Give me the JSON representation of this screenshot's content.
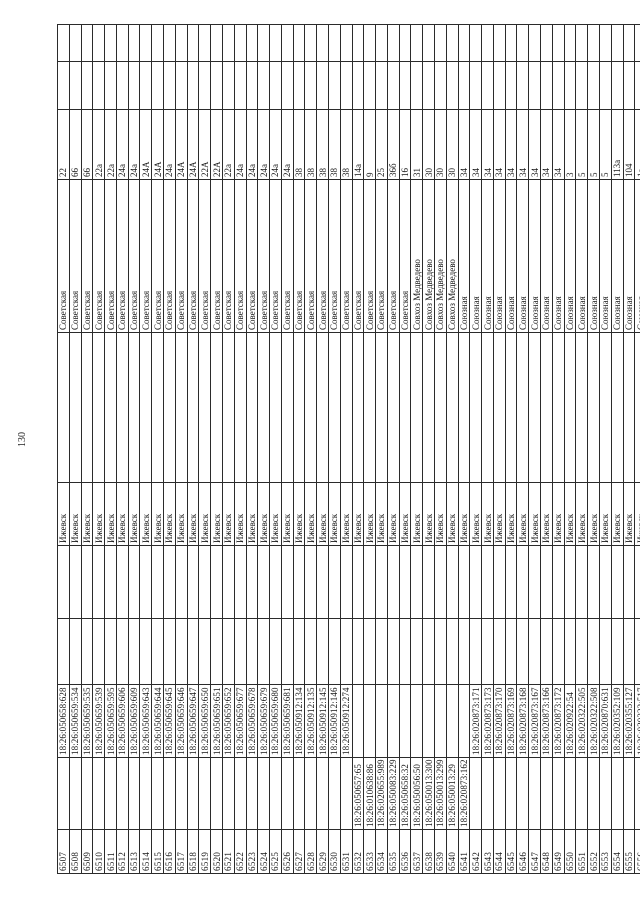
{
  "page": {
    "number": "130"
  },
  "table": {
    "city_note": "city column value repeated on every row",
    "rows": [
      {
        "n": "6507",
        "c2": "",
        "c3": "18:26:050658:628",
        "city": "Ижевск",
        "street": "Советская",
        "house": "22"
      },
      {
        "n": "6508",
        "c2": "",
        "c3": "18:26:050659:534",
        "city": "Ижевск",
        "street": "Советская",
        "house": "66"
      },
      {
        "n": "6509",
        "c2": "",
        "c3": "18:26:050659:535",
        "city": "Ижевск",
        "street": "Советская",
        "house": "66"
      },
      {
        "n": "6510",
        "c2": "",
        "c3": "18:26:050659:539",
        "city": "Ижевск",
        "street": "Советская",
        "house": "22а"
      },
      {
        "n": "6511",
        "c2": "",
        "c3": "18:26:050659:595",
        "city": "Ижевск",
        "street": "Советская",
        "house": "22а"
      },
      {
        "n": "6512",
        "c2": "",
        "c3": "18:26:050659:606",
        "city": "Ижевск",
        "street": "Советская",
        "house": "24а"
      },
      {
        "n": "6513",
        "c2": "",
        "c3": "18:26:050659:609",
        "city": "Ижевск",
        "street": "Советская",
        "house": "24а"
      },
      {
        "n": "6514",
        "c2": "",
        "c3": "18:26:050659:643",
        "city": "Ижевск",
        "street": "Советская",
        "house": "24А"
      },
      {
        "n": "6515",
        "c2": "",
        "c3": "18:26:050659:644",
        "city": "Ижевск",
        "street": "Советская",
        "house": "24А"
      },
      {
        "n": "6516",
        "c2": "",
        "c3": "18:26:050659:645",
        "city": "Ижевск",
        "street": "Советская",
        "house": "24а"
      },
      {
        "n": "6517",
        "c2": "",
        "c3": "18:26:050659:646",
        "city": "Ижевск",
        "street": "Советская",
        "house": "24А"
      },
      {
        "n": "6518",
        "c2": "",
        "c3": "18:26:050659:647",
        "city": "Ижевск",
        "street": "Советская",
        "house": "24А"
      },
      {
        "n": "6519",
        "c2": "",
        "c3": "18:26:050659:650",
        "city": "Ижевск",
        "street": "Советская",
        "house": "22А"
      },
      {
        "n": "6520",
        "c2": "",
        "c3": "18:26:050659:651",
        "city": "Ижевск",
        "street": "Советская",
        "house": "22А"
      },
      {
        "n": "6521",
        "c2": "",
        "c3": "18:26:050659:652",
        "city": "Ижевск",
        "street": "Советская",
        "house": "22а"
      },
      {
        "n": "6522",
        "c2": "",
        "c3": "18:26:050659:677",
        "city": "Ижевск",
        "street": "Советская",
        "house": "24а"
      },
      {
        "n": "6523",
        "c2": "",
        "c3": "18:26:050659:678",
        "city": "Ижевск",
        "street": "Советская",
        "house": "24а"
      },
      {
        "n": "6524",
        "c2": "",
        "c3": "18:26:050659:679",
        "city": "Ижевск",
        "street": "Советская",
        "house": "24а"
      },
      {
        "n": "6525",
        "c2": "",
        "c3": "18:26:050659:680",
        "city": "Ижевск",
        "street": "Советская",
        "house": "24а"
      },
      {
        "n": "6526",
        "c2": "",
        "c3": "18:26:050659:681",
        "city": "Ижевск",
        "street": "Советская",
        "house": "24а"
      },
      {
        "n": "6527",
        "c2": "",
        "c3": "18:26:050912:134",
        "city": "Ижевск",
        "street": "Советская",
        "house": "38"
      },
      {
        "n": "6528",
        "c2": "",
        "c3": "18:26:050912:135",
        "city": "Ижевск",
        "street": "Советская",
        "house": "38"
      },
      {
        "n": "6529",
        "c2": "",
        "c3": "18:26:050912:145",
        "city": "Ижевск",
        "street": "Советская",
        "house": "38"
      },
      {
        "n": "6530",
        "c2": "",
        "c3": "18:26:050912:146",
        "city": "Ижевск",
        "street": "Советская",
        "house": "38"
      },
      {
        "n": "6531",
        "c2": "",
        "c3": "18:26:050912:274",
        "city": "Ижевск",
        "street": "Советская",
        "house": "38"
      },
      {
        "n": "6532",
        "c2": "18:26:050657:65",
        "c3": "",
        "city": "Ижевск",
        "street": "Советская",
        "house": "14а"
      },
      {
        "n": "6533",
        "c2": "18:26:010638:86",
        "c3": "",
        "city": "Ижевск",
        "street": "Советская",
        "house": "9"
      },
      {
        "n": "6534",
        "c2": "18:26:020655:989",
        "c3": "",
        "city": "Ижевск",
        "street": "Советская",
        "house": "25"
      },
      {
        "n": "6535",
        "c2": "18:26:050083:229",
        "c3": "",
        "city": "Ижевск",
        "street": "Советская",
        "house": "36б"
      },
      {
        "n": "6536",
        "c2": "18:26:050658:32",
        "c3": "",
        "city": "Ижевск",
        "street": "Советская",
        "house": "16"
      },
      {
        "n": "6537",
        "c2": "18:26:050056:50",
        "c3": "",
        "city": "Ижевск",
        "street": "Совхоз Медведево",
        "house": "31"
      },
      {
        "n": "6538",
        "c2": "18:26:050013:300",
        "c3": "",
        "city": "Ижевск",
        "street": "Совхоз Медведево",
        "house": "30"
      },
      {
        "n": "6539",
        "c2": "18:26:050013:299",
        "c3": "",
        "city": "Ижевск",
        "street": "Совхоз Медведево",
        "house": "30"
      },
      {
        "n": "6540",
        "c2": "18:26:050013:29",
        "c3": "",
        "city": "Ижевск",
        "street": "Совхоз Медведево",
        "house": "30"
      },
      {
        "n": "6541",
        "c2": "18:26:020873:162",
        "c3": "",
        "city": "Ижевск",
        "street": "Союзная",
        "house": "34"
      },
      {
        "n": "6542",
        "c2": "",
        "c3": "18:26:020873:171",
        "city": "Ижевск",
        "street": "Союзная",
        "house": "34"
      },
      {
        "n": "6543",
        "c2": "",
        "c3": "18:26:020873:173",
        "city": "Ижевск",
        "street": "Союзная",
        "house": "34"
      },
      {
        "n": "6544",
        "c2": "",
        "c3": "18:26:020873:170",
        "city": "Ижевск",
        "street": "Союзная",
        "house": "34"
      },
      {
        "n": "6545",
        "c2": "",
        "c3": "18:26:020873:169",
        "city": "Ижевск",
        "street": "Союзная",
        "house": "34"
      },
      {
        "n": "6546",
        "c2": "",
        "c3": "18:26:020873:168",
        "city": "Ижевск",
        "street": "Союзная",
        "house": "34"
      },
      {
        "n": "6547",
        "c2": "",
        "c3": "18:26:020873:167",
        "city": "Ижевск",
        "street": "Союзная",
        "house": "34"
      },
      {
        "n": "6548",
        "c2": "",
        "c3": "18:26:020873:166",
        "city": "Ижевск",
        "street": "Союзная",
        "house": "34"
      },
      {
        "n": "6549",
        "c2": "",
        "c3": "18:26:020873:172",
        "city": "Ижевск",
        "street": "Союзная",
        "house": "34"
      },
      {
        "n": "6550",
        "c2": "",
        "c3": "18:26:020922:54",
        "city": "Ижевск",
        "street": "Союзная",
        "house": "3"
      },
      {
        "n": "6551",
        "c2": "",
        "c3": "18:26:020322:505",
        "city": "Ижевск",
        "street": "Союзная",
        "house": "5"
      },
      {
        "n": "6552",
        "c2": "",
        "c3": "18:26:020322:508",
        "city": "Ижевск",
        "street": "Союзная",
        "house": "5"
      },
      {
        "n": "6553",
        "c2": "",
        "c3": "18:26:020870:631",
        "city": "Ижевск",
        "street": "Союзная",
        "house": "5"
      },
      {
        "n": "6554",
        "c2": "",
        "c3": "18:26:020352:109",
        "city": "Ижевск",
        "street": "Союзная",
        "house": "113а"
      },
      {
        "n": "6555",
        "c2": "",
        "c3": "18:26:020355:127",
        "city": "Ижевск",
        "street": "Союзная",
        "house": "104"
      },
      {
        "n": "6556",
        "c2": "",
        "c3": "18:26:020322:517",
        "city": "Ижевск",
        "street": "Союзная",
        "house": "1а"
      },
      {
        "n": "6557",
        "c2": "",
        "c3": "18:26:020322:518",
        "city": "Ижевск",
        "street": "Союзная",
        "house": "1а"
      },
      {
        "n": "6558",
        "c2": "",
        "c3": "18:26:020322:519",
        "city": "Ижевск",
        "street": "Союзная",
        "house": "1а"
      },
      {
        "n": "6559",
        "c2": "",
        "c3": "18:26:020322:520",
        "city": "Ижевск",
        "street": "Союзная",
        "house": "1а"
      },
      {
        "n": "6560",
        "c2": "",
        "c3": "18:26:020322:521",
        "city": "Ижевск",
        "street": "Союзная",
        "house": "1а"
      }
    ]
  }
}
